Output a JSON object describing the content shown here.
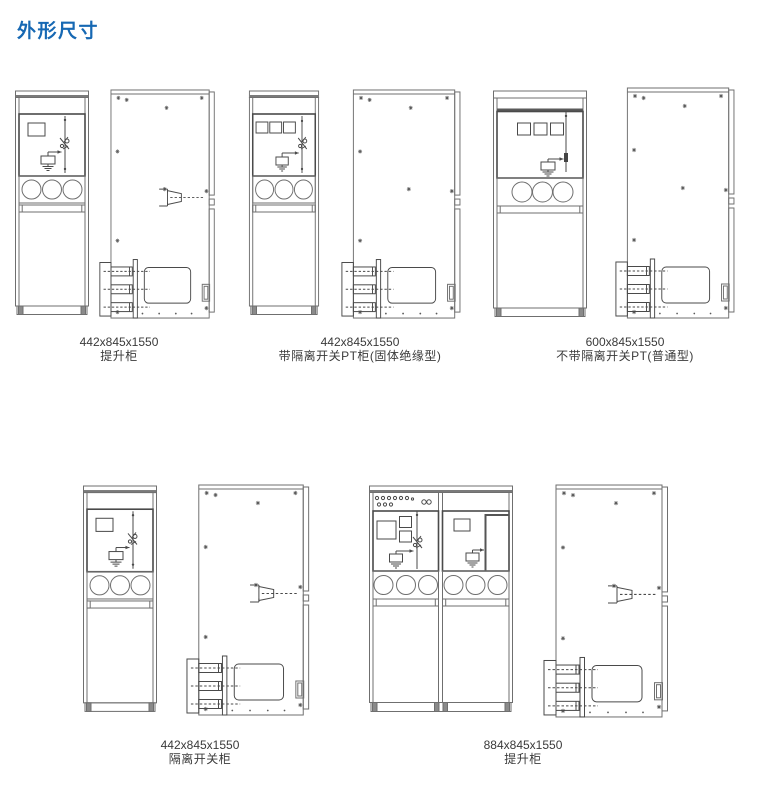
{
  "page": {
    "title": "外形尺寸"
  },
  "figures": [
    {
      "dimensions": "442x845x1550",
      "name": "提升柜"
    },
    {
      "dimensions": "442x845x1550",
      "name": "带隔离开关PT柜(固体绝缘型)"
    },
    {
      "dimensions": "600x845x1550",
      "name": "不带隔离开关PT(普通型)"
    },
    {
      "dimensions": "442x845x1550",
      "name": "隔离开关柜"
    },
    {
      "dimensions": "884x845x1550",
      "name": "提升柜"
    }
  ],
  "colors": {
    "title_blue": "#1668b3",
    "line_gray": "#6f6f6f",
    "line_dark": "#4a4a4a"
  }
}
